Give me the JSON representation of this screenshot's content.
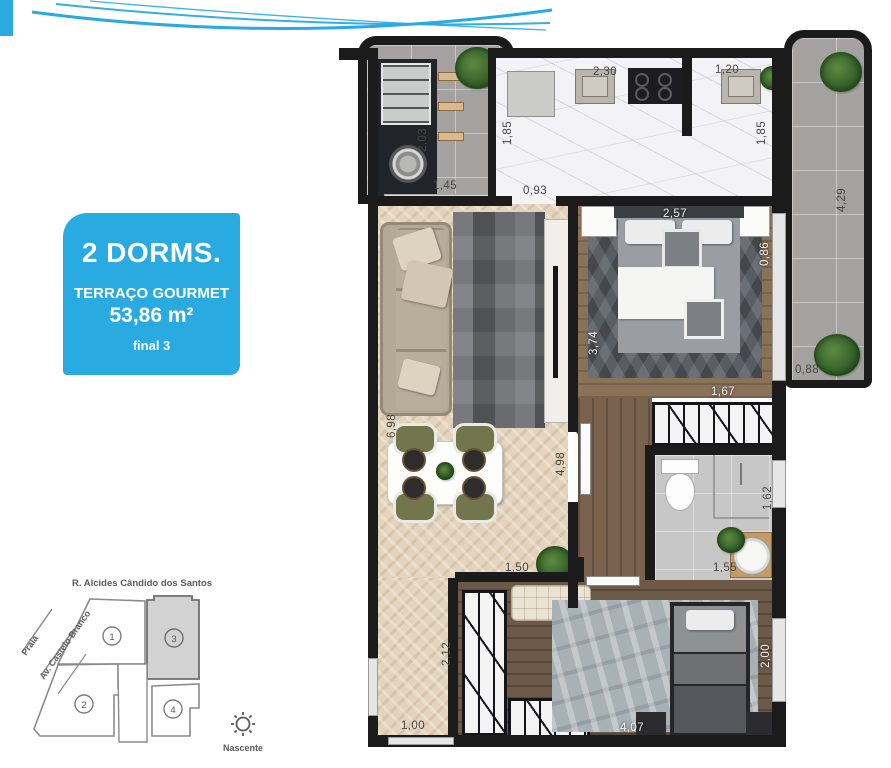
{
  "colors": {
    "accent_blue": "#29abe2",
    "wall": "#1b1b1b",
    "lot_highlight": "#d2d2d2"
  },
  "info_box": {
    "line1": "2 DORMS.",
    "line2": "TERRAÇO GOURMET",
    "line3": "53,86 m²",
    "line4": "final 3"
  },
  "site_plan": {
    "street": "R. Alcides Cândido dos Santos",
    "diagonal_label_1": "Praia",
    "diagonal_label_2": "Av. Castelo Branco",
    "units": [
      "1",
      "2",
      "3",
      "4"
    ],
    "highlighted_unit": "3",
    "sun_label": "Nascente"
  },
  "plan": {
    "dims": {
      "terrace_depth": "2,03",
      "terrace_grill": "1,45",
      "kitchen_left": "1,85",
      "kitchen_sink": "2,30",
      "kitchen_sink2": "1,20",
      "kitchen_right": "1,85",
      "kitchen_pass": "0,93",
      "side_terrace_len": "4,29",
      "side_terrace_w": "0,88",
      "bed1_width": "2,57",
      "bed1_window": "0,86",
      "bed1_len": "3,74",
      "bed1_wardrobe": "1,67",
      "living_len": "6,98",
      "hall_len": "4,98",
      "hall_w": "1,50",
      "bath_depth": "1,62",
      "bath_w": "1,55",
      "bed2_hall": "2,12",
      "bed2_window_b": "1,00",
      "bed2_len": "4,07",
      "bed2_window": "2,00"
    }
  }
}
